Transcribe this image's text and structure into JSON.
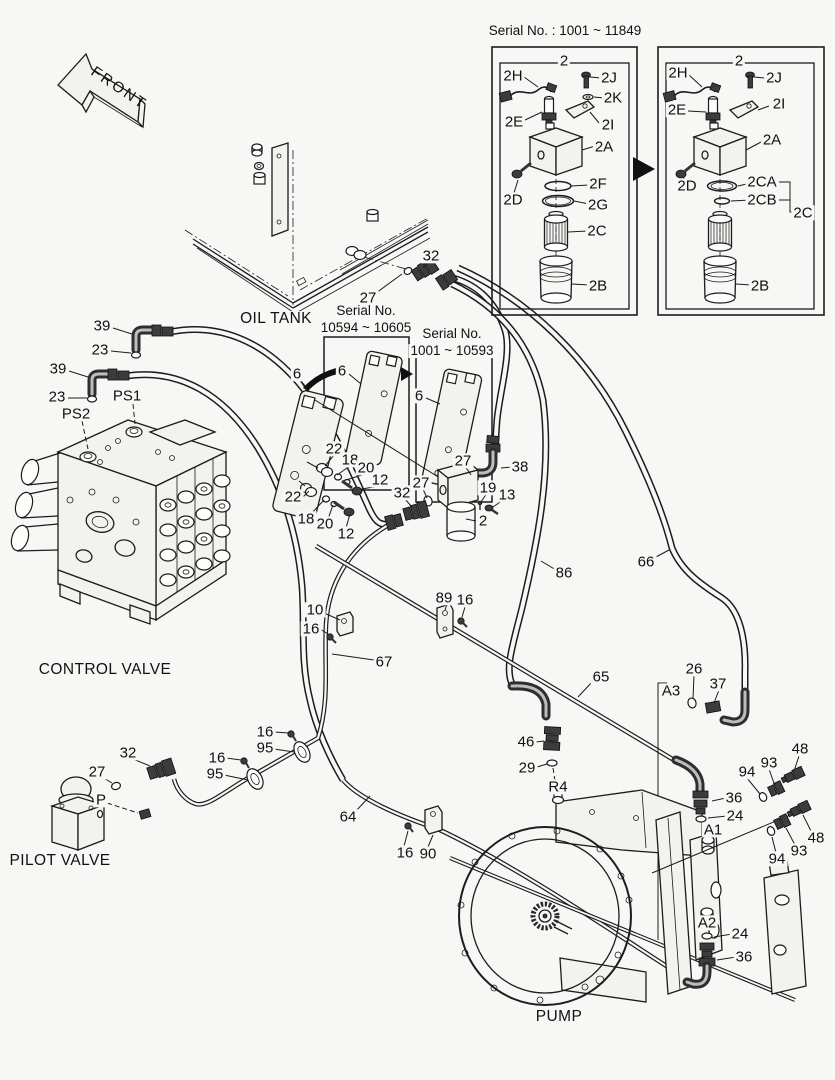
{
  "colors": {
    "background": "#f7f7f5",
    "line": "#1c1c1c"
  },
  "front": {
    "label": "FRONT"
  },
  "serial_note": {
    "title": "Serial No. : 1001 ~ 11849",
    "left_box_parts": [
      "2",
      "2H",
      "2J",
      "2K",
      "2E",
      "2I",
      "2A",
      "2D",
      "2F",
      "2G",
      "2C",
      "2B"
    ],
    "right_box_parts": [
      "2",
      "2H",
      "2J",
      "2E",
      "2I",
      "2A",
      "2D",
      "2CA",
      "2CB",
      "2C",
      "2B"
    ]
  },
  "serial_plates": [
    {
      "line1": "Serial No.",
      "line2": "10594 ~ 10605",
      "part": "6"
    },
    {
      "line1": "Serial No.",
      "line2": "1001 ~ 10593",
      "part": "6"
    }
  ],
  "sections": {
    "oil_tank": "OIL TANK",
    "control_valve": "CONTROL VALVE",
    "pilot_valve": "PILOT VALVE",
    "pump": "PUMP"
  },
  "ports": [
    "PS1",
    "PS2",
    "P",
    "A1",
    "A2",
    "A3",
    "R4"
  ],
  "labels": [
    {
      "t": "Serial No. : 1001 ~ 11849",
      "x": 565,
      "y": 31,
      "c": "ser",
      "n": "serial-note-title"
    },
    {
      "t": "2",
      "x": 564,
      "y": 61
    },
    {
      "t": "2H",
      "x": 513,
      "y": 76
    },
    {
      "t": "2J",
      "x": 609,
      "y": 78
    },
    {
      "t": "2K",
      "x": 613,
      "y": 98
    },
    {
      "t": "2E",
      "x": 514,
      "y": 122
    },
    {
      "t": "2I",
      "x": 608,
      "y": 125
    },
    {
      "t": "2A",
      "x": 604,
      "y": 147
    },
    {
      "t": "2D",
      "x": 513,
      "y": 200
    },
    {
      "t": "2F",
      "x": 598,
      "y": 184
    },
    {
      "t": "2G",
      "x": 598,
      "y": 205
    },
    {
      "t": "2C",
      "x": 597,
      "y": 231
    },
    {
      "t": "2B",
      "x": 598,
      "y": 286
    },
    {
      "t": "2",
      "x": 739,
      "y": 61
    },
    {
      "t": "2H",
      "x": 678,
      "y": 73
    },
    {
      "t": "2J",
      "x": 774,
      "y": 78
    },
    {
      "t": "2E",
      "x": 677,
      "y": 110
    },
    {
      "t": "2I",
      "x": 779,
      "y": 104
    },
    {
      "t": "2A",
      "x": 772,
      "y": 140
    },
    {
      "t": "2D",
      "x": 687,
      "y": 186
    },
    {
      "t": "2CA",
      "x": 762,
      "y": 182
    },
    {
      "t": "2CB",
      "x": 762,
      "y": 200
    },
    {
      "t": "2C",
      "x": 803,
      "y": 213
    },
    {
      "t": "2B",
      "x": 760,
      "y": 286
    },
    {
      "t": "39",
      "x": 102,
      "y": 326
    },
    {
      "t": "23",
      "x": 100,
      "y": 350
    },
    {
      "t": "39",
      "x": 58,
      "y": 369
    },
    {
      "t": "23",
      "x": 57,
      "y": 397
    },
    {
      "t": "PS1",
      "x": 127,
      "y": 396,
      "n": "port-ps1"
    },
    {
      "t": "PS2",
      "x": 76,
      "y": 414,
      "n": "port-ps2"
    },
    {
      "t": "OIL TANK",
      "x": 276,
      "y": 319,
      "c": "sec",
      "n": "section-oil-tank"
    },
    {
      "t": "27",
      "x": 368,
      "y": 298
    },
    {
      "t": "32",
      "x": 431,
      "y": 256
    },
    {
      "t": "Serial No.",
      "x": 366,
      "y": 311,
      "c": "ser"
    },
    {
      "t": "10594 ~ 10605",
      "x": 366,
      "y": 328,
      "c": "ser"
    },
    {
      "t": "Serial No.",
      "x": 452,
      "y": 334,
      "c": "ser"
    },
    {
      "t": "1001 ~ 10593",
      "x": 452,
      "y": 351,
      "c": "ser"
    },
    {
      "t": "6",
      "x": 297,
      "y": 374
    },
    {
      "t": "6",
      "x": 342,
      "y": 371
    },
    {
      "t": "6",
      "x": 419,
      "y": 396
    },
    {
      "t": "22",
      "x": 334,
      "y": 449
    },
    {
      "t": "18",
      "x": 350,
      "y": 460
    },
    {
      "t": "20",
      "x": 366,
      "y": 468
    },
    {
      "t": "12",
      "x": 380,
      "y": 480
    },
    {
      "t": "22",
      "x": 293,
      "y": 497
    },
    {
      "t": "18",
      "x": 306,
      "y": 519
    },
    {
      "t": "20",
      "x": 325,
      "y": 524
    },
    {
      "t": "12",
      "x": 346,
      "y": 534
    },
    {
      "t": "32",
      "x": 402,
      "y": 493
    },
    {
      "t": "27",
      "x": 421,
      "y": 483
    },
    {
      "t": "27",
      "x": 463,
      "y": 461
    },
    {
      "t": "38",
      "x": 520,
      "y": 467
    },
    {
      "t": "19",
      "x": 488,
      "y": 488
    },
    {
      "t": "13",
      "x": 507,
      "y": 495
    },
    {
      "t": "2",
      "x": 483,
      "y": 521
    },
    {
      "t": "86",
      "x": 564,
      "y": 573
    },
    {
      "t": "66",
      "x": 646,
      "y": 562
    },
    {
      "t": "10",
      "x": 315,
      "y": 610
    },
    {
      "t": "16",
      "x": 311,
      "y": 629
    },
    {
      "t": "89",
      "x": 444,
      "y": 598
    },
    {
      "t": "16",
      "x": 465,
      "y": 600
    },
    {
      "t": "67",
      "x": 384,
      "y": 662
    },
    {
      "t": "65",
      "x": 601,
      "y": 677
    },
    {
      "t": "A3",
      "x": 671,
      "y": 691,
      "n": "port-a3"
    },
    {
      "t": "26",
      "x": 694,
      "y": 669
    },
    {
      "t": "37",
      "x": 718,
      "y": 684
    },
    {
      "t": "46",
      "x": 526,
      "y": 742
    },
    {
      "t": "29",
      "x": 527,
      "y": 768
    },
    {
      "t": "R4",
      "x": 558,
      "y": 787,
      "n": "port-r4"
    },
    {
      "t": "16",
      "x": 265,
      "y": 732
    },
    {
      "t": "95",
      "x": 265,
      "y": 748
    },
    {
      "t": "16",
      "x": 217,
      "y": 758
    },
    {
      "t": "95",
      "x": 215,
      "y": 774
    },
    {
      "t": "32",
      "x": 128,
      "y": 753
    },
    {
      "t": "27",
      "x": 97,
      "y": 772
    },
    {
      "t": "P",
      "x": 101,
      "y": 800,
      "n": "port-p"
    },
    {
      "t": "CONTROL VALVE",
      "x": 105,
      "y": 670,
      "c": "sec",
      "n": "section-control-valve"
    },
    {
      "t": "64",
      "x": 348,
      "y": 817
    },
    {
      "t": "16",
      "x": 405,
      "y": 853
    },
    {
      "t": "90",
      "x": 428,
      "y": 854
    },
    {
      "t": "PILOT VALVE",
      "x": 60,
      "y": 861,
      "c": "sec",
      "n": "section-pilot-valve"
    },
    {
      "t": "94",
      "x": 747,
      "y": 772
    },
    {
      "t": "93",
      "x": 769,
      "y": 763
    },
    {
      "t": "48",
      "x": 800,
      "y": 749
    },
    {
      "t": "36",
      "x": 734,
      "y": 798
    },
    {
      "t": "24",
      "x": 735,
      "y": 816
    },
    {
      "t": "A1",
      "x": 713,
      "y": 830,
      "n": "port-a1"
    },
    {
      "t": "48",
      "x": 816,
      "y": 838
    },
    {
      "t": "93",
      "x": 799,
      "y": 851
    },
    {
      "t": "94",
      "x": 777,
      "y": 859
    },
    {
      "t": "A2",
      "x": 707,
      "y": 923,
      "n": "port-a2"
    },
    {
      "t": "24",
      "x": 740,
      "y": 934
    },
    {
      "t": "36",
      "x": 744,
      "y": 957
    },
    {
      "t": "PUMP",
      "x": 559,
      "y": 1017,
      "c": "sec",
      "n": "section-pump"
    }
  ]
}
